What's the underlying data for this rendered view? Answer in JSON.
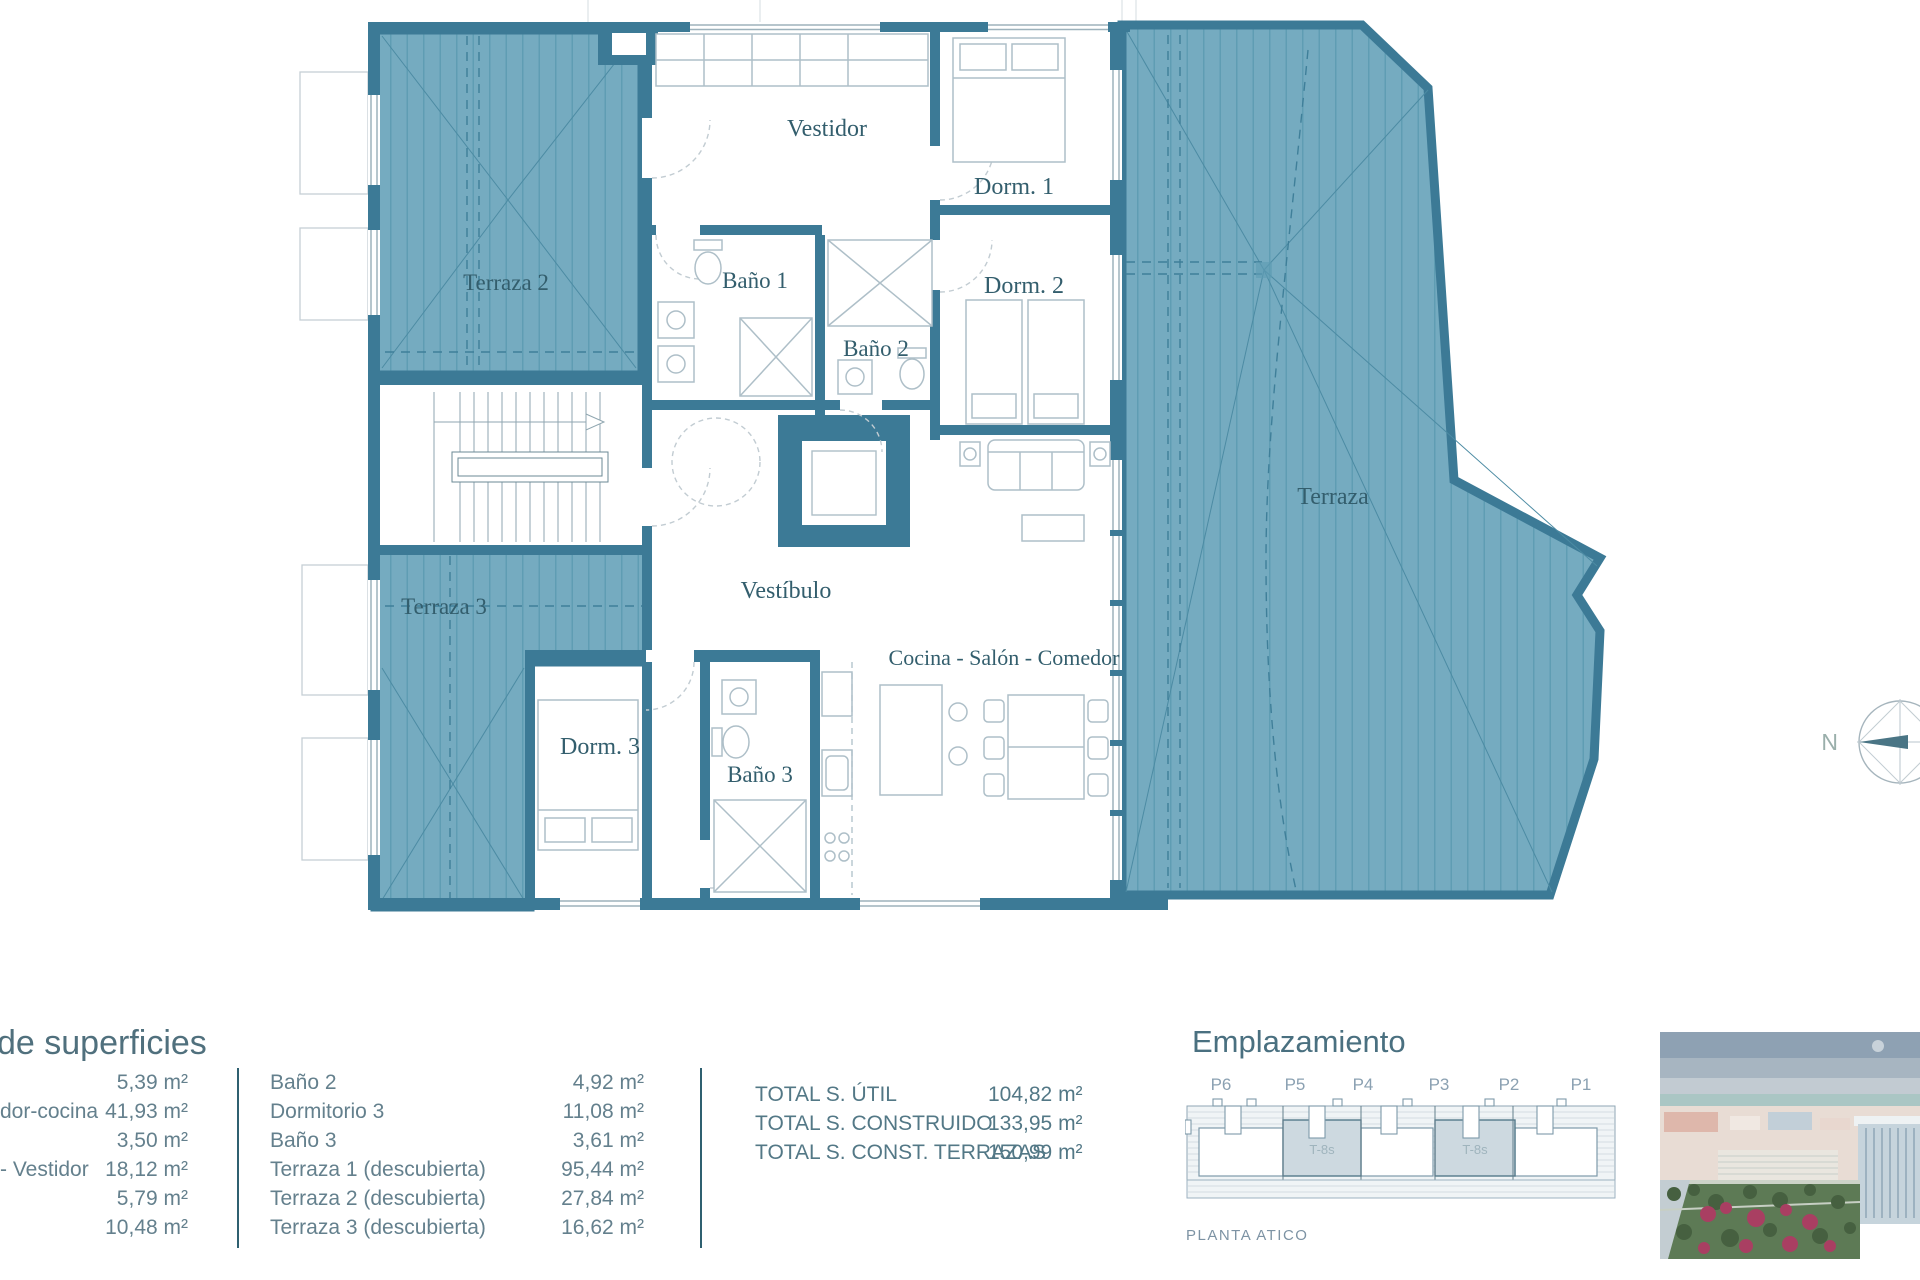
{
  "plan": {
    "labels": {
      "terraza2": "Terraza 2",
      "terraza3": "Terraza 3",
      "terraza": "Terraza",
      "vestidor": "Vestidor",
      "dorm1": "Dorm. 1",
      "dorm2": "Dorm. 2",
      "bano1": "Baño 1",
      "bano2": "Baño 2",
      "bano3": "Baño 3",
      "vestibulo": "Vestíbulo",
      "dorm3": "Dorm. 3",
      "cocina": "Cocina - Salón - Comedor"
    },
    "compass_north": "N"
  },
  "surfaces": {
    "title": "de superficies",
    "left_rows": [
      {
        "label": "",
        "value": "5,39 m²"
      },
      {
        "label": "dor-cocina",
        "value": "41,93 m²"
      },
      {
        "label": "",
        "value": "3,50 m²"
      },
      {
        "label": "- Vestidor",
        "value": "18,12 m²"
      },
      {
        "label": "",
        "value": "5,79 m²"
      },
      {
        "label": "",
        "value": "10,48 m²"
      }
    ],
    "middle_rows": [
      {
        "label": "Baño 2",
        "value": "4,92 m²"
      },
      {
        "label": "Dormitorio 3",
        "value": "11,08 m²"
      },
      {
        "label": "Baño 3",
        "value": "3,61 m²"
      },
      {
        "label": "Terraza 1 (descubierta)",
        "value": "95,44 m²"
      },
      {
        "label": "Terraza 2 (descubierta)",
        "value": "27,84 m²"
      },
      {
        "label": "Terraza 3 (descubierta)",
        "value": "16,62 m²"
      }
    ],
    "totals": [
      {
        "label": "TOTAL S. ÚTIL",
        "value": "104,82 m²"
      },
      {
        "label": "TOTAL S. CONSTRUIDO",
        "value": "133,95 m²"
      },
      {
        "label": "TOTAL S. CONST. TERRAZAS",
        "value": "150,99 m²"
      }
    ]
  },
  "emplazamiento": {
    "title": "Emplazamiento",
    "portals": [
      "P6",
      "P5",
      "P4",
      "P3",
      "P2",
      "P1"
    ],
    "unit_label_1": "T-8s",
    "unit_label_2": "T-8s",
    "caption": "PLANTA ATICO"
  },
  "colors": {
    "wall_teal": "#3c7a96",
    "terrace_fill": "#75abc0",
    "terrace_hatch": "#5f9db3",
    "plan_label": "#335e6d",
    "table_text": "#64808d",
    "divider": "#2f6070"
  }
}
